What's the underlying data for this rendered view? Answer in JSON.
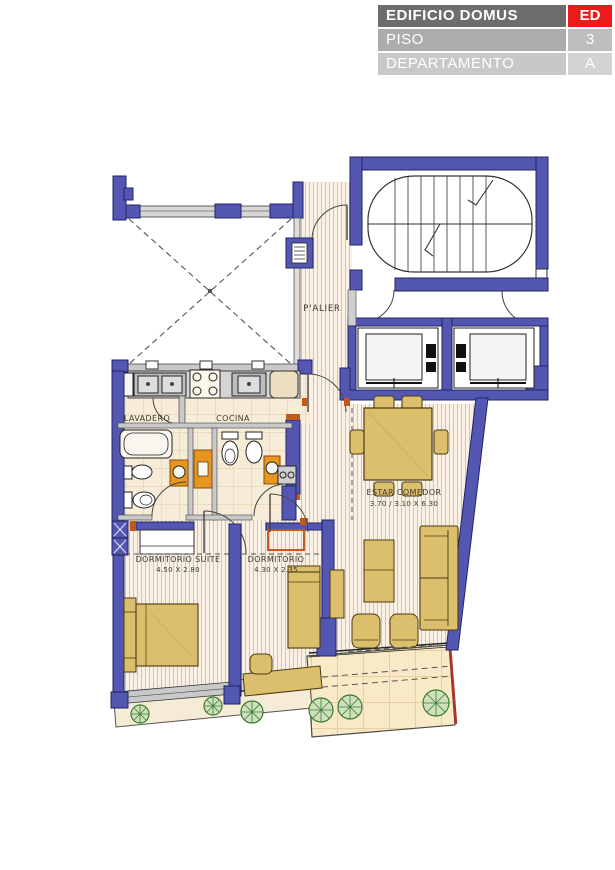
{
  "title_block": {
    "building_label": "EDIFICIO DOMUS",
    "building_code": "ED",
    "floor_label": "PISO",
    "floor_value": "3",
    "unit_label": "DEPARTAMENTO",
    "unit_value": "A"
  },
  "rooms": {
    "palier": {
      "name": "P'ALIER"
    },
    "lavadero": {
      "name": "LAVADERO"
    },
    "cocina": {
      "name": "COCINA"
    },
    "estar_comedor": {
      "name": "ESTAR COMEDOR",
      "dimensions": "3.70 / 3.10 X 6.30"
    },
    "dormitorio_suite": {
      "name": "DORMITORIO SUITE",
      "dimensions": "4.50 X 2.80"
    },
    "dormitorio": {
      "name": "DORMITORIO",
      "dimensions": "4.30 X 2.35"
    }
  },
  "colors": {
    "wall_blue": "#5457b1",
    "accent_red": "#ec1a1a",
    "furniture_tan": "#dcbf6c",
    "cabinet_orange": "#e8951f",
    "plant_green": "#3c7a34",
    "balcony_edge_red": "#b03024"
  }
}
